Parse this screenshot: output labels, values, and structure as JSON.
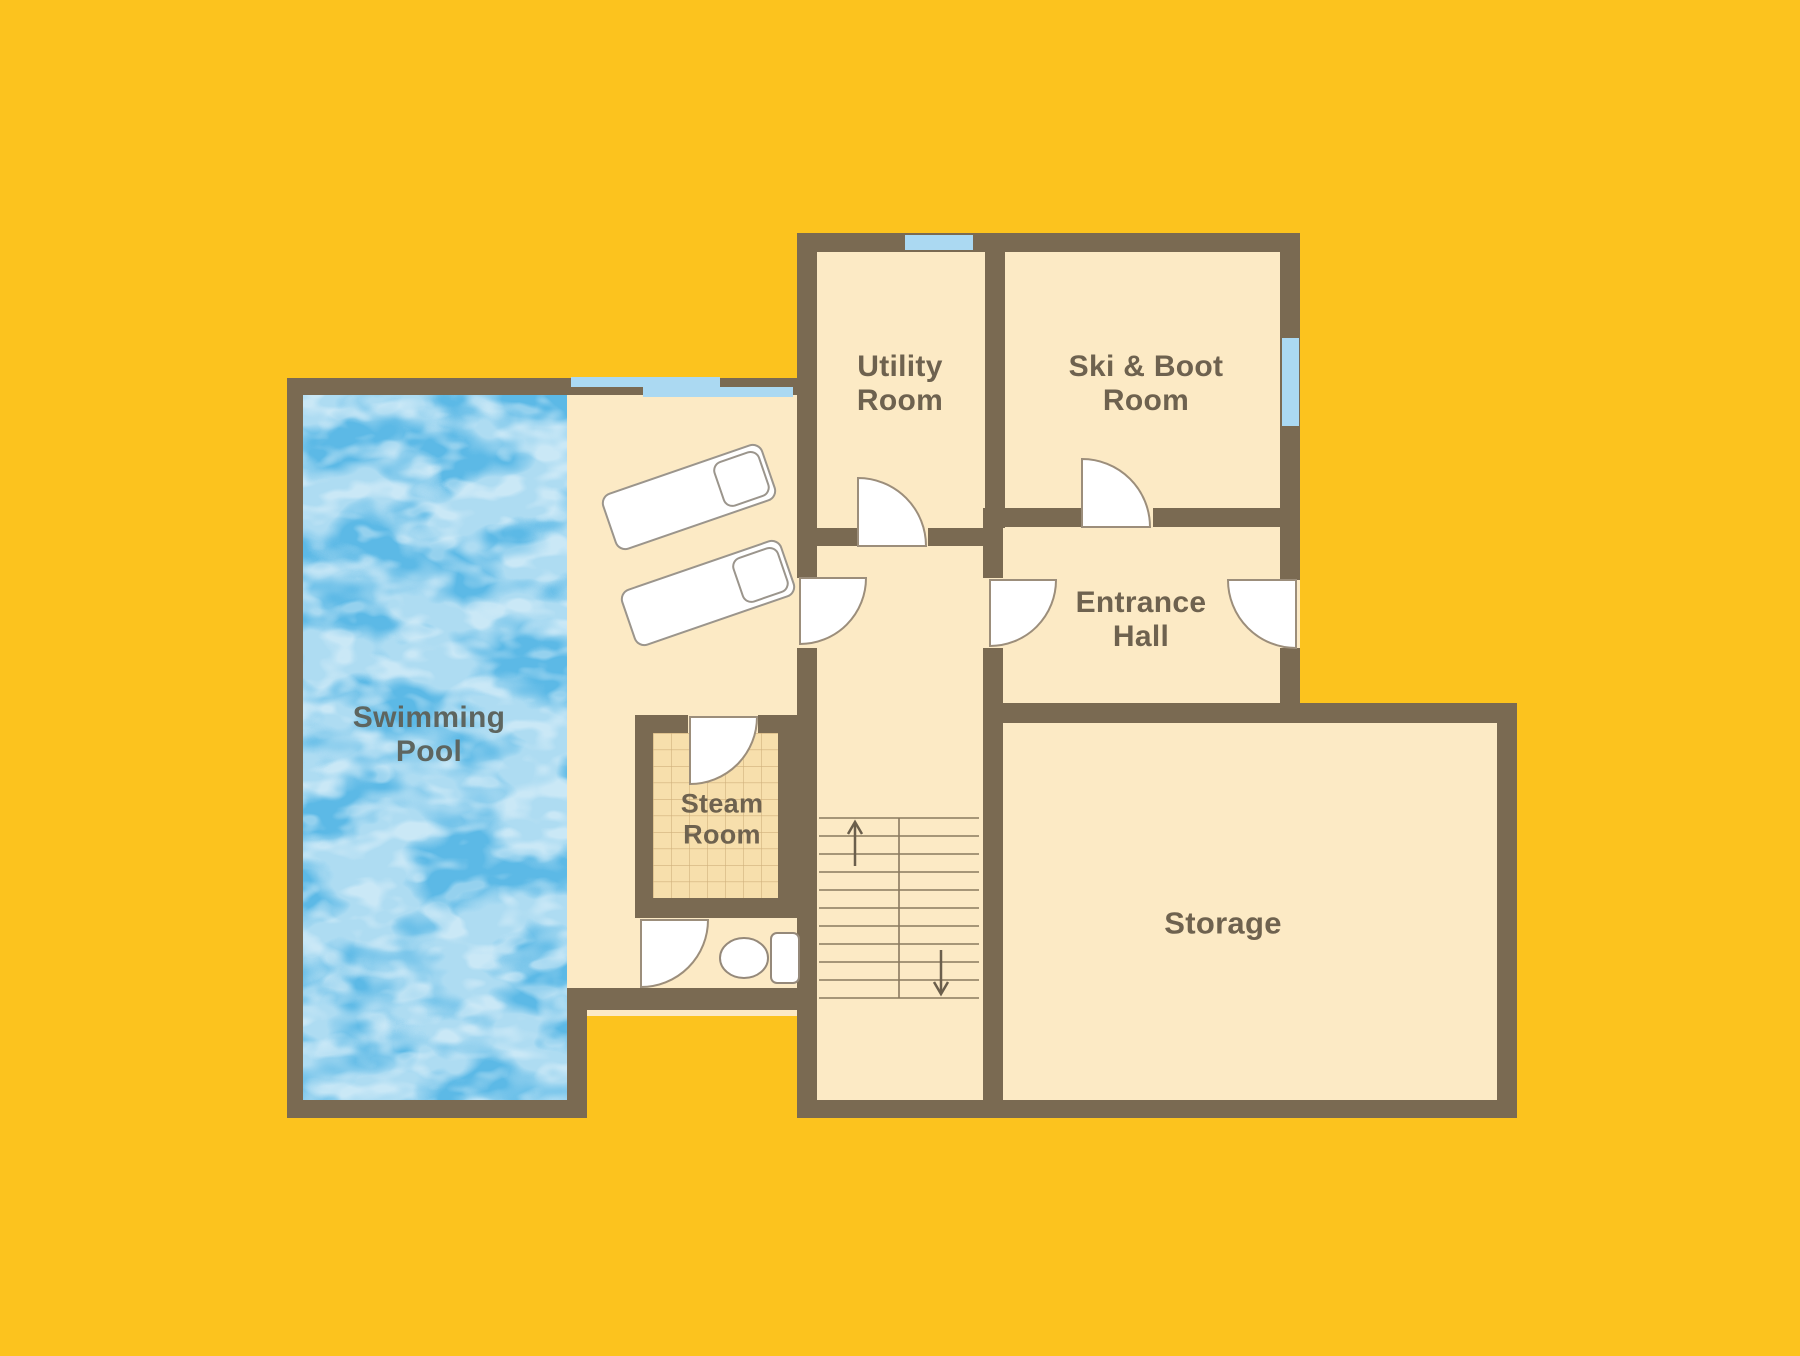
{
  "plan": {
    "type": "floor-plan",
    "description_of_pixels": "Basement-style floor plan on amber background with brown walls, cream floors, blue swimming pool"
  },
  "rooms": {
    "swimming_pool": {
      "line1": "Swimming",
      "line2": "Pool"
    },
    "utility_room": {
      "line1": "Utility",
      "line2": "Room"
    },
    "ski_boot_room": {
      "line1": "Ski & Boot",
      "line2": "Room"
    },
    "entrance_hall": {
      "line1": "Entrance",
      "line2": "Hall"
    },
    "steam_room": {
      "line1": "Steam",
      "line2": "Room"
    },
    "storage": {
      "line1": "Storage"
    }
  },
  "fixtures": {
    "loungers": 2,
    "toilet": 1,
    "doors": 7,
    "windows": 4,
    "stairs": {
      "flights": 2,
      "up_symbol": "↑",
      "down_symbol": "↓"
    }
  },
  "colors": {
    "background": "#FCC31E",
    "wall": "#7A6A52",
    "floor": "#FCEAC5",
    "steam_tile": "#F7DFAC",
    "window": "#ABD9F2",
    "pool_water": "#5CB9E6",
    "label_text": "#6E624F",
    "pool_label_text": "#5E655F",
    "fixture_outline": "#9C8E7B"
  }
}
